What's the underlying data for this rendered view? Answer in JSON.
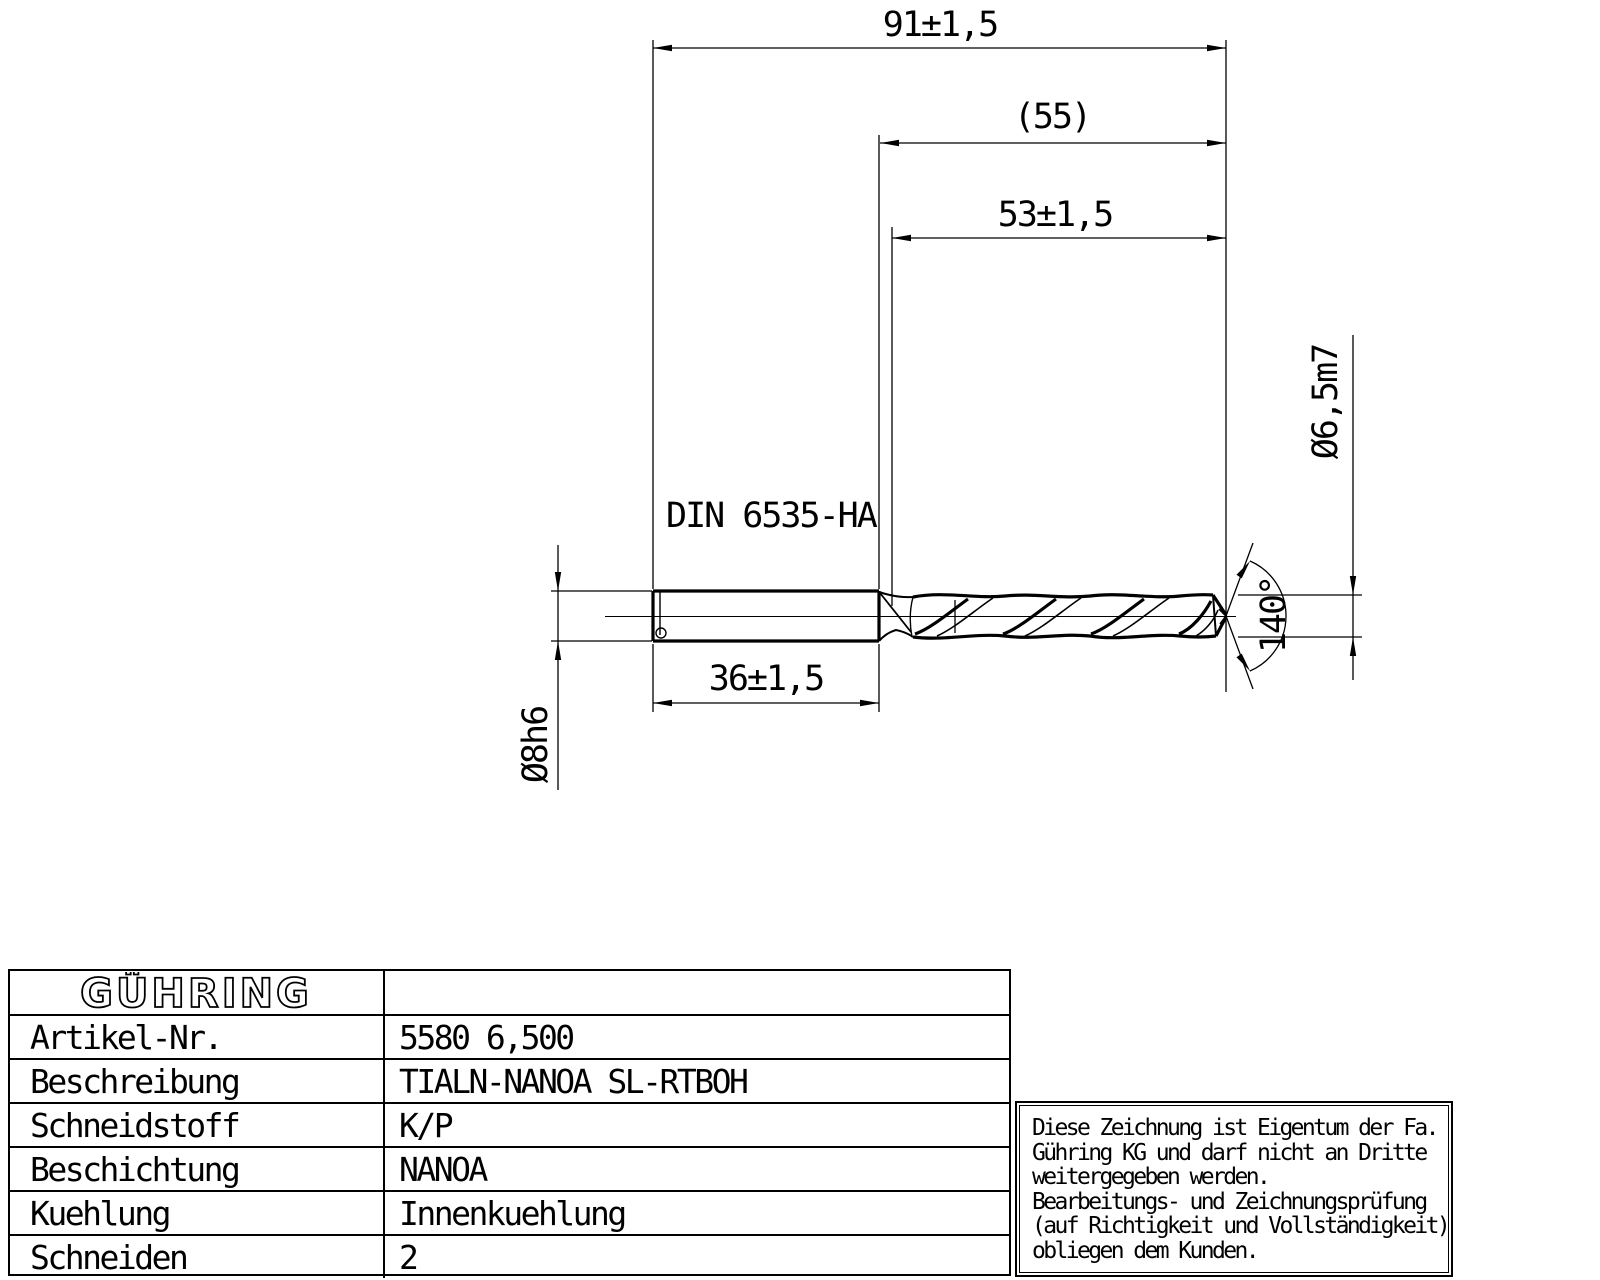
{
  "dims": {
    "overall_length": "91±1,5",
    "ref_length": "(55)",
    "flute_length": "53±1,5",
    "shank_length": "36±1,5",
    "shank_diameter": "Ø8h6",
    "cutting_diameter": "Ø6,5m7",
    "point_angle": "140°",
    "shank_standard": "DIN 6535-HA"
  },
  "table": {
    "brand": "GÜHRING",
    "rows": [
      {
        "label": "Artikel-Nr.",
        "value": "5580 6,500"
      },
      {
        "label": "Beschreibung",
        "value": "TIALN-NANOA SL-RTBOH"
      },
      {
        "label": "Schneidstoff",
        "value": "K/P"
      },
      {
        "label": "Beschichtung",
        "value": "NANOA"
      },
      {
        "label": "Kuehlung",
        "value": "Innenkuehlung"
      },
      {
        "label": "Schneiden",
        "value": "2"
      }
    ]
  },
  "notice": {
    "lines": [
      "Diese Zeichnung ist Eigentum der Fa.",
      "Gühring KG und darf nicht an Dritte",
      "weitergegeben werden.",
      "Bearbeitungs- und Zeichnungsprüfung",
      "(auf Richtigkeit und Vollständigkeit)",
      "obliegen dem Kunden."
    ]
  }
}
